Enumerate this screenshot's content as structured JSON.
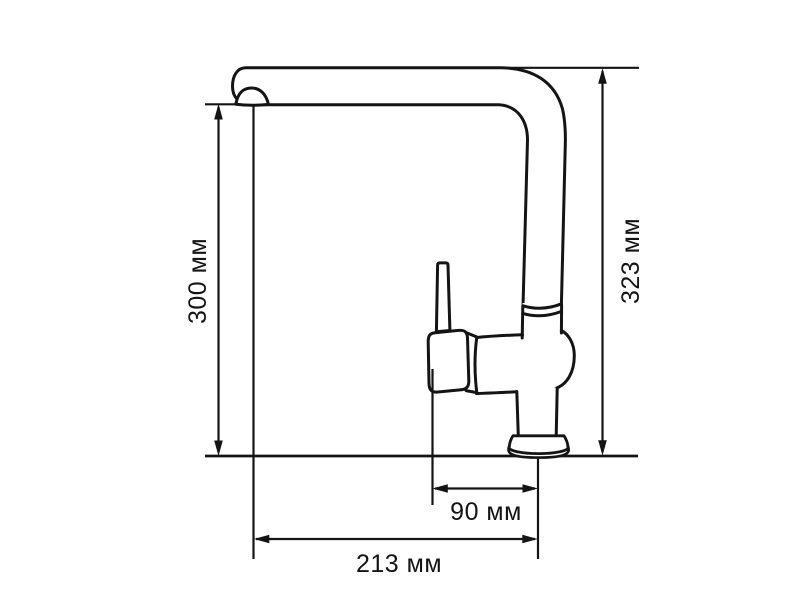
{
  "page": {
    "background": "#ffffff",
    "line_color": "#141414",
    "description": "Technical dimension drawing of a single-lever kitchen faucet, side view"
  },
  "diagram": {
    "subject": "kitchen-faucet-side-view",
    "unit": "мм",
    "dimensions": [
      {
        "id": "spout-height",
        "value": 300,
        "unit": "мм",
        "label": "300 мм",
        "orientation": "vertical",
        "position": "left",
        "measures": "height from mounting surface to underside of spout"
      },
      {
        "id": "total-height",
        "value": 323,
        "unit": "мм",
        "label": "323 мм",
        "orientation": "vertical",
        "position": "right",
        "measures": "overall faucet height"
      },
      {
        "id": "base-offset",
        "value": 90,
        "unit": "мм",
        "label": "90 мм",
        "orientation": "horizontal",
        "position": "bottom-upper",
        "measures": "handle to base axis distance"
      },
      {
        "id": "spout-reach",
        "value": 213,
        "unit": "мм",
        "label": "213 мм",
        "orientation": "horizontal",
        "position": "bottom-lower",
        "measures": "spout outlet to base axis reach"
      }
    ]
  }
}
